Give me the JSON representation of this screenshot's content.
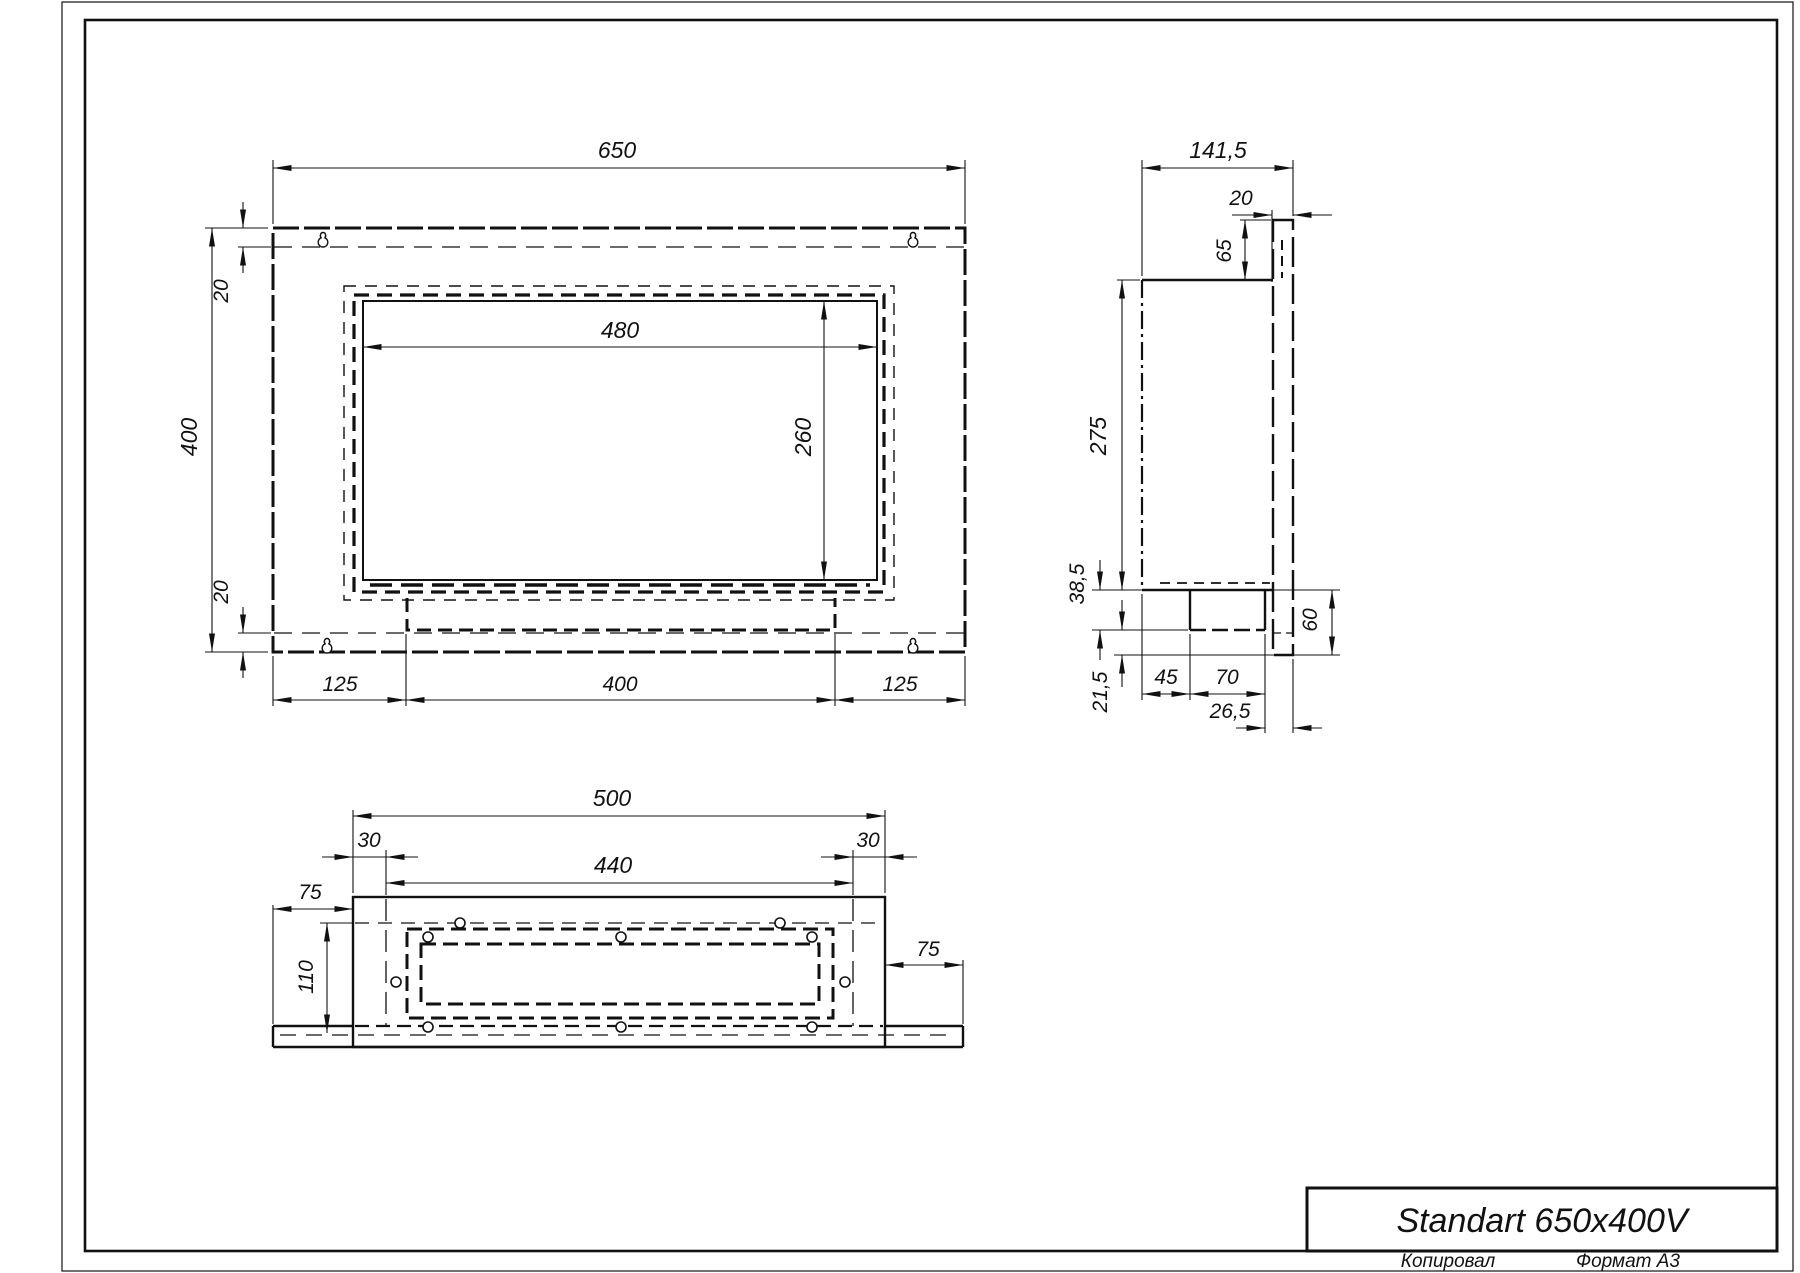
{
  "title_block": {
    "title": "Standart 650x400V",
    "footer_left": "Копировал",
    "footer_right": "Формат А3"
  },
  "views": {
    "front": {
      "dims": {
        "width": "650",
        "height": "400",
        "top_offset": "20",
        "bottom_offset": "20",
        "opening_width": "480",
        "opening_height": "260",
        "left_margin": "125",
        "burner_width": "400",
        "right_margin": "125"
      }
    },
    "side": {
      "dims": {
        "depth": "141,5",
        "flange_width": "20",
        "top_inset": "65",
        "body_height": "275",
        "lower_height": "38,5",
        "foot_height": "21,5",
        "bottom_total": "60",
        "inset_left": "45",
        "burner_depth": "70",
        "flange_offset": "26,5"
      }
    },
    "bottom": {
      "dims": {
        "box_width": "500",
        "left_wall": "30",
        "right_wall": "30",
        "inner_width": "440",
        "flange_left": "75",
        "flange_right": "75",
        "depth": "110"
      }
    }
  },
  "colors": {
    "line": "#111111",
    "background": "#ffffff"
  }
}
